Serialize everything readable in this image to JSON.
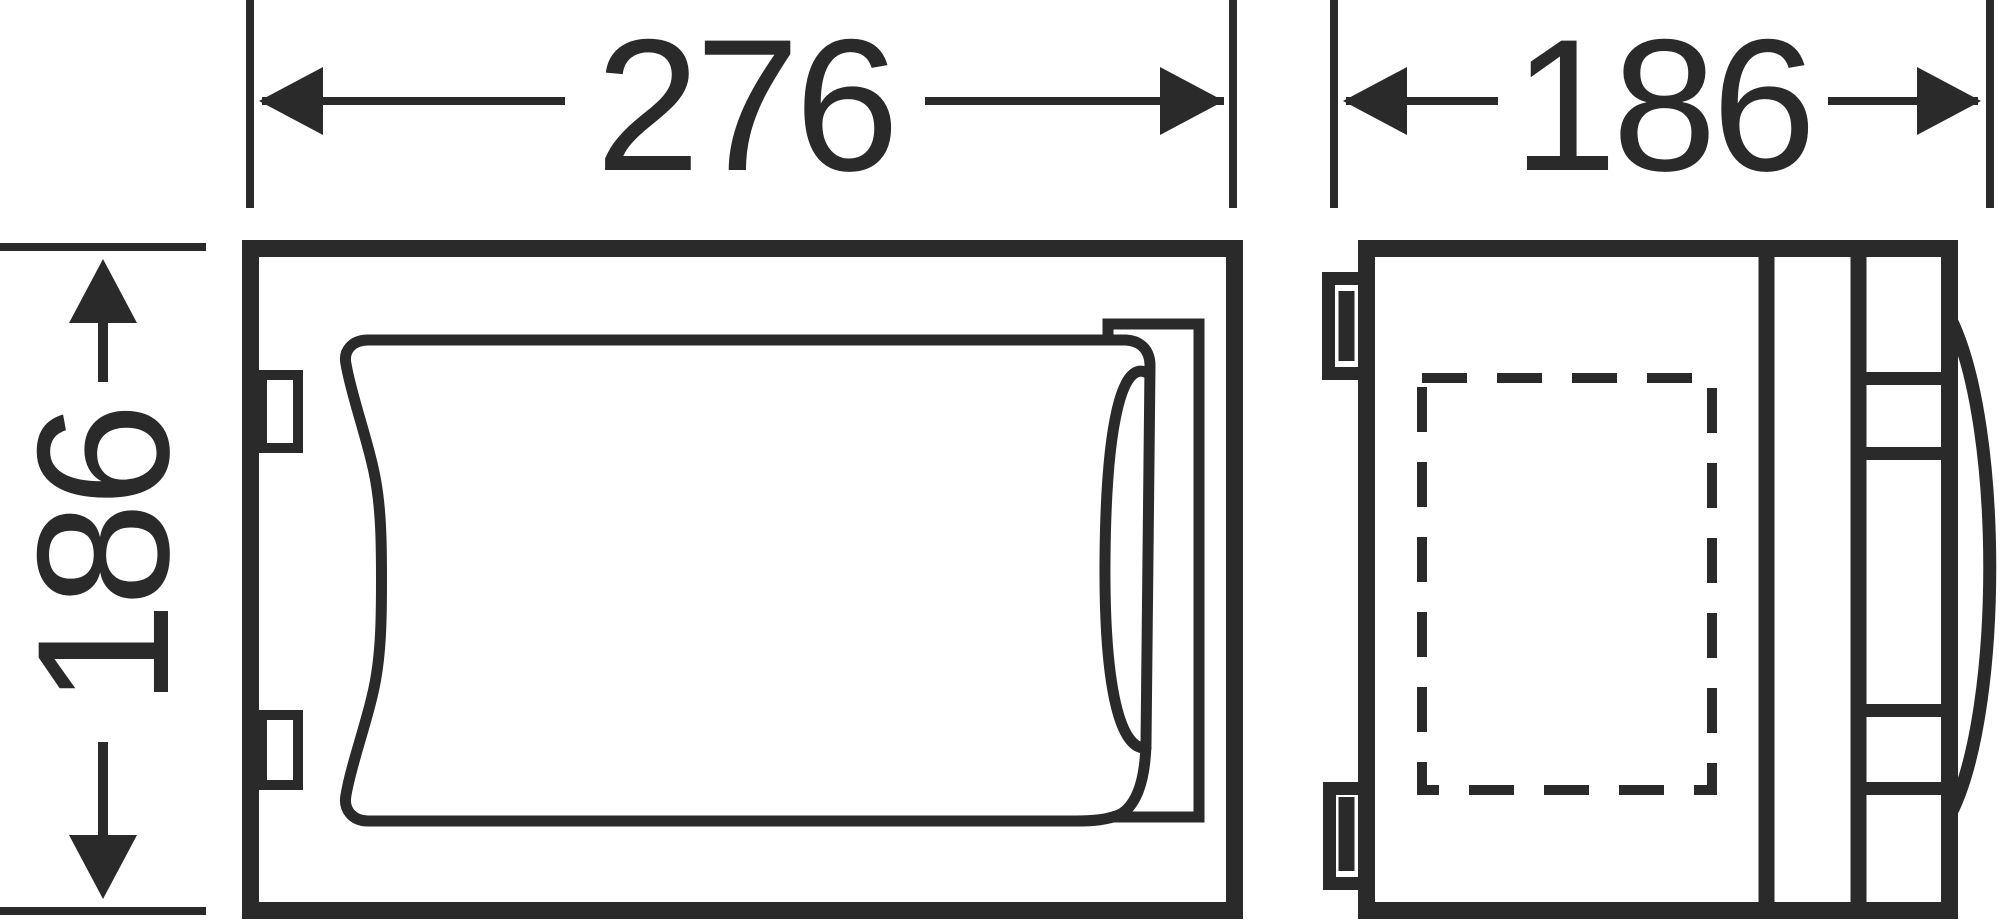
{
  "page": {
    "background_color": "#ffffff"
  },
  "drawing": {
    "type": "technical-dimension-drawing",
    "ink_color": "#2a2a2a",
    "views": {
      "front_view": {
        "description": "front view of unit with curved cover and side flap"
      },
      "side_view": {
        "description": "side view of unit with wall brackets, dashed recess, hinge rail and handle"
      }
    },
    "dimensions": {
      "front_width": {
        "value": "276"
      },
      "side_depth": {
        "value": "186"
      },
      "front_height": {
        "value": "186"
      }
    }
  }
}
